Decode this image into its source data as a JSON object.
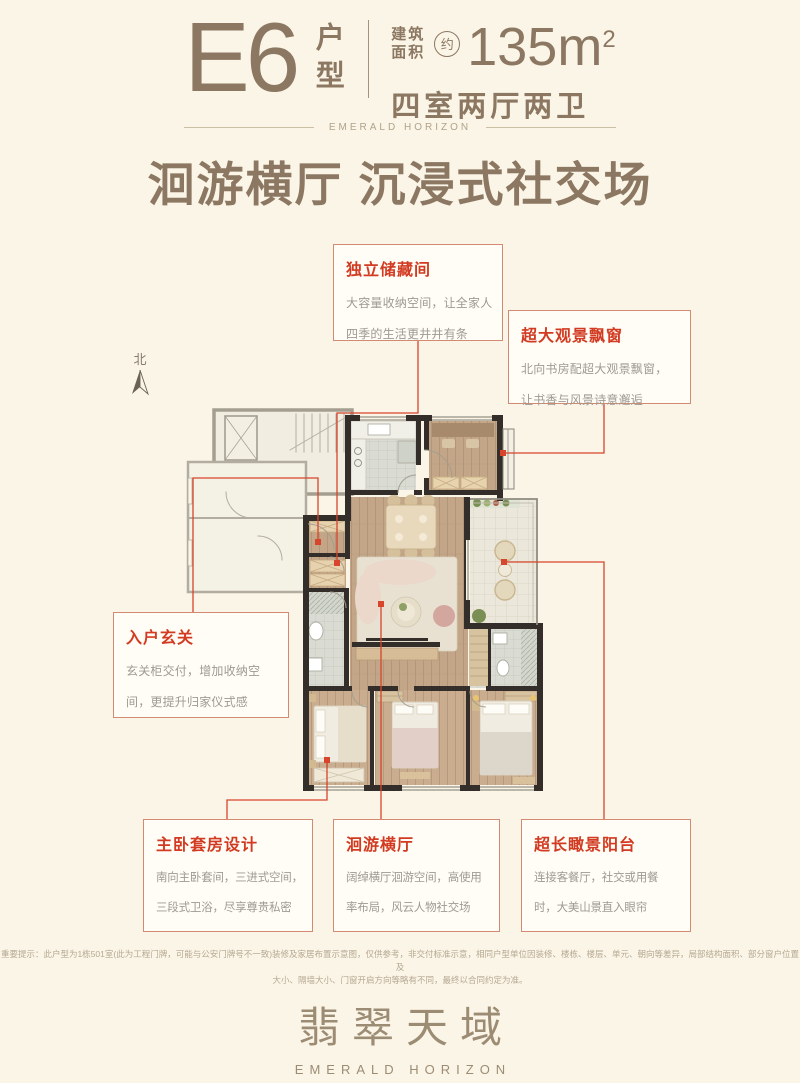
{
  "header": {
    "plan_code": "E6",
    "plan_type": "户型",
    "area_label_1": "建筑",
    "area_label_2": "面积",
    "approx": "约",
    "area_value": "135m",
    "area_sup": "2",
    "layout": "四室两厅两卫",
    "brand_en": "EMERALD HORIZON"
  },
  "title": "洄游横厅 沉浸式社交场",
  "north_label": "北",
  "callouts": [
    {
      "id": "storage",
      "title": "独立储藏间",
      "lines": [
        "大容量收纳空间，让全家人",
        "四季的生活更井井有条"
      ]
    },
    {
      "id": "baywindow",
      "title": "超大观景飘窗",
      "lines": [
        "北向书房配超大观景飘窗，",
        "让书香与风景诗意邂逅"
      ]
    },
    {
      "id": "foyer",
      "title": "入户玄关",
      "lines": [
        "玄关柜交付，增加收纳空",
        "间，更提升归家仪式感"
      ]
    },
    {
      "id": "master",
      "title": "主卧套房设计",
      "lines": [
        "南向主卧套间，三进式空间，",
        "三段式卫浴，尽享尊贵私密"
      ]
    },
    {
      "id": "hall",
      "title": "洄游横厅",
      "lines": [
        "阔绰横厅洄游空间，高使用",
        "率布局，风云人物社交场"
      ]
    },
    {
      "id": "balcony",
      "title": "超长瞰景阳台",
      "lines": [
        "连接客餐厅，社交或用餐",
        "时，大美山景直入眼帘"
      ]
    }
  ],
  "disclaimer_lines": [
    "重要提示：此户型为1栋501室(此为工程门牌，可能与公安门牌号不一致)装修及家居布置示意图，仅供参考，非交付标准示意，相同户型单位因装修、楼栋、楼层、单元、朝向等差异，局部结构面积、部分窗户位置及",
    "大小、隔墙大小、门窗开启方向等略有不同，最终以合同约定为准。"
  ],
  "footer": {
    "brand_cn": "翡翠天域",
    "brand_en": "EMERALD HORIZON"
  },
  "colors": {
    "background": "#fbf5e7",
    "header_taupe": "#8c7862",
    "callout_red": "#d23b21",
    "callout_border": "#d28a72",
    "leader_red": "#d6452c",
    "wall_dark": "#332e29",
    "wood": "#c3a687",
    "common_gray": "#a39e90"
  }
}
